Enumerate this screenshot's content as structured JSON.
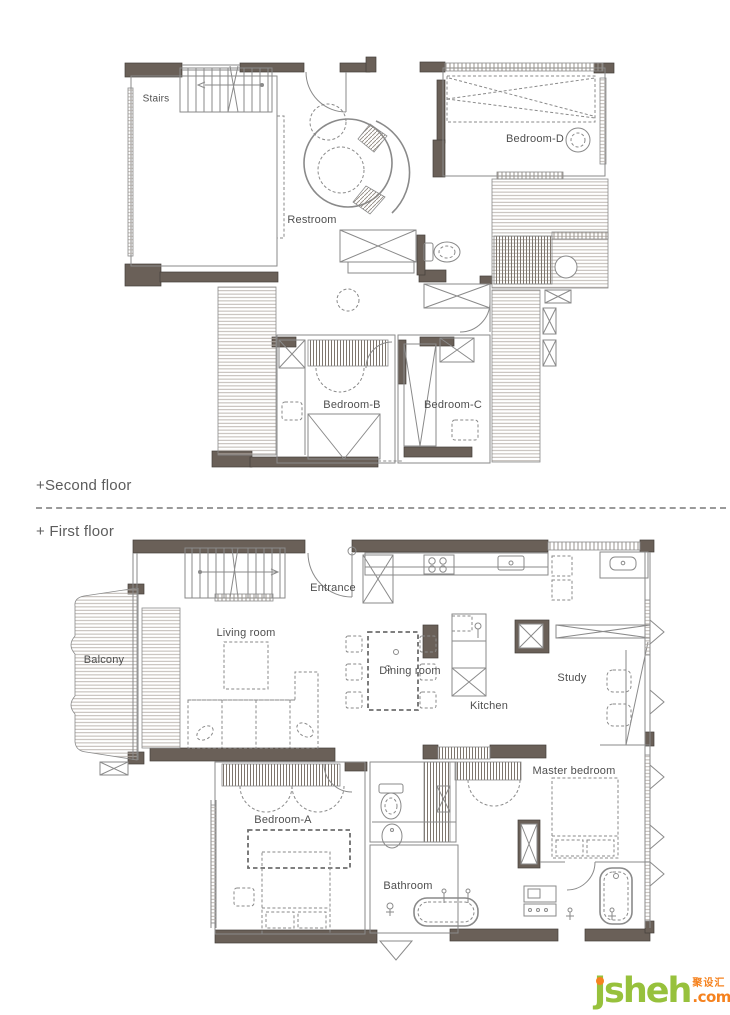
{
  "page": {
    "width": 730,
    "height": 1015,
    "background": "#ffffff"
  },
  "floors": [
    {
      "id": "second",
      "section_label": "+Second floor",
      "rooms": [
        {
          "label": "Stairs"
        },
        {
          "label": "Restroom"
        },
        {
          "label": "Bedroom-D"
        },
        {
          "label": "Bedroom-B"
        },
        {
          "label": "Bedroom-C"
        }
      ]
    },
    {
      "id": "first",
      "section_label": "+ First floor",
      "rooms": [
        {
          "label": "Entrance"
        },
        {
          "label": "Living room"
        },
        {
          "label": "Balcony"
        },
        {
          "label": "Dining room"
        },
        {
          "label": "Kitchen"
        },
        {
          "label": "Study"
        },
        {
          "label": "Master bedroom"
        },
        {
          "label": "Bedroom-A"
        },
        {
          "label": "Bathroom"
        }
      ]
    }
  ],
  "logo": {
    "brand": "jsheh",
    "tld": ".com",
    "cn": "聚设汇"
  },
  "colors": {
    "wall": "#6a6058",
    "line": "#8a8a8a",
    "hatch": "#b3aca7",
    "text": "#5c5c5c",
    "label_text": "#4f4f4f",
    "logo_green": "#97c13c",
    "logo_orange": "#f5821f",
    "divider": "#9a9a9a"
  }
}
